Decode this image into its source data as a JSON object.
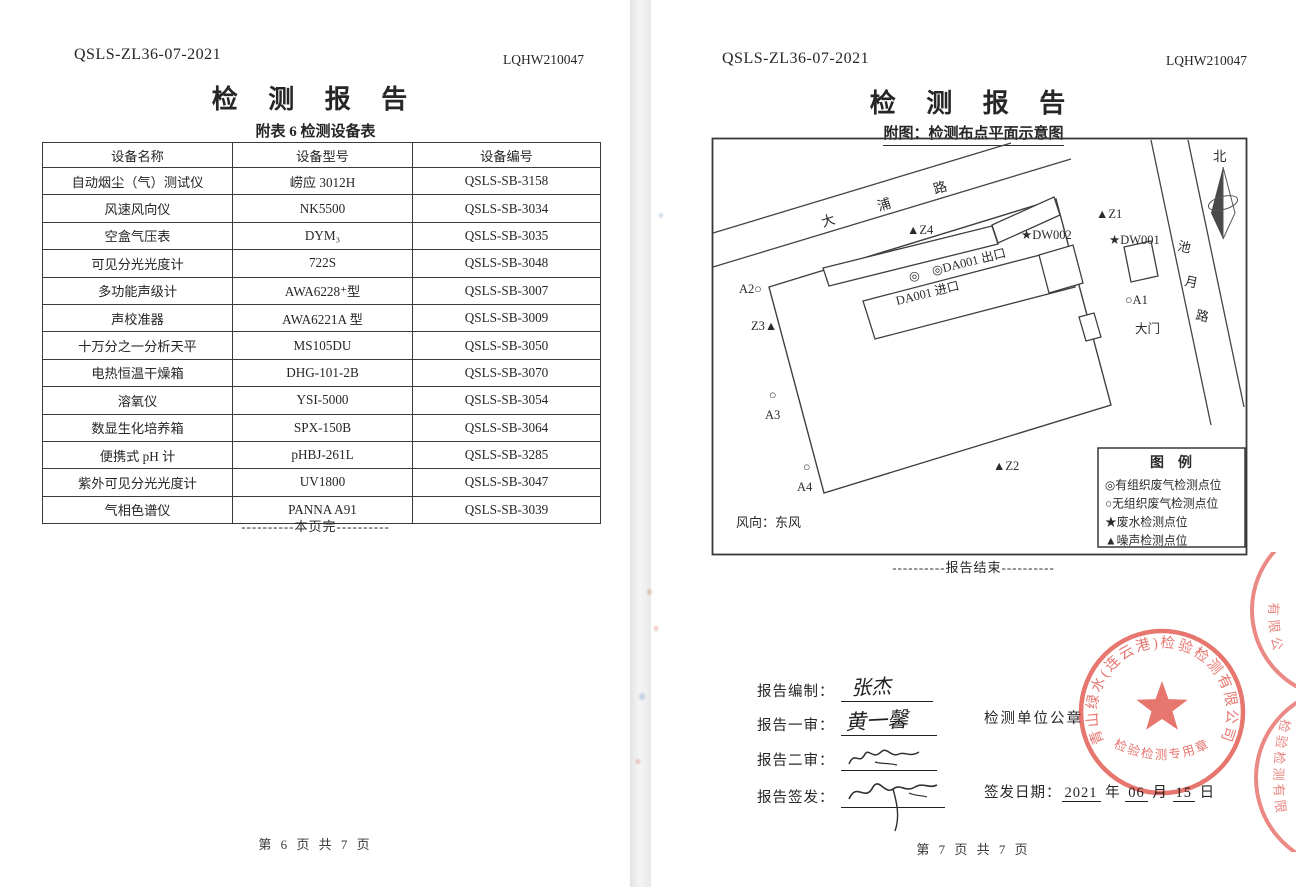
{
  "pages": {
    "left": {
      "doc_code": "QSLS-ZL36-07-2021",
      "report_no": "LQHW210047",
      "title": "检 测 报 告",
      "subtitle": "附表 6  检测设备表",
      "equipment_table": {
        "headers": [
          "设备名称",
          "设备型号",
          "设备编号"
        ],
        "rows": [
          [
            "自动烟尘（气）测试仪",
            "崂应 3012H",
            "QSLS-SB-3158"
          ],
          [
            "风速风向仪",
            "NK5500",
            "QSLS-SB-3034"
          ],
          [
            "空盒气压表",
            "DYM₃",
            "QSLS-SB-3035"
          ],
          [
            "可见分光光度计",
            "722S",
            "QSLS-SB-3048"
          ],
          [
            "多功能声级计",
            "AWA6228⁺型",
            "QSLS-SB-3007"
          ],
          [
            "声校准器",
            "AWA6221A 型",
            "QSLS-SB-3009"
          ],
          [
            "十万分之一分析天平",
            "MS105DU",
            "QSLS-SB-3050"
          ],
          [
            "电热恒温干燥箱",
            "DHG-101-2B",
            "QSLS-SB-3070"
          ],
          [
            "溶氧仪",
            "YSI-5000",
            "QSLS-SB-3054"
          ],
          [
            "数显生化培养箱",
            "SPX-150B",
            "QSLS-SB-3064"
          ],
          [
            "便携式 pH 计",
            "pHBJ-261L",
            "QSLS-SB-3285"
          ],
          [
            "紫外可见分光光度计",
            "UV1800",
            "QSLS-SB-3047"
          ],
          [
            "气相色谱仪",
            "PANNA A91",
            "QSLS-SB-3039"
          ]
        ]
      },
      "end_of_page": "----------本页完----------",
      "page_footer": "第 6 页 共 7 页"
    },
    "right": {
      "doc_code": "QSLS-ZL36-07-2021",
      "report_no": "LQHW210047",
      "title": "检 测 报 告",
      "subtitle": "附图：检测布点平面示意图",
      "diagram": {
        "roads": [
          {
            "name": "大浦路"
          },
          {
            "name": "池月路"
          }
        ],
        "north_label": "北",
        "wind_label": "风向：东风",
        "labels": [
          {
            "t": "北",
            "x": 502,
            "y": 24,
            "fs": 13.5
          },
          {
            "t": "大",
            "x": 112,
            "y": 90,
            "r": -17,
            "fs": 13.5
          },
          {
            "t": "浦",
            "x": 168,
            "y": 74,
            "r": -17,
            "fs": 13.5
          },
          {
            "t": "路",
            "x": 224,
            "y": 57,
            "r": -17,
            "fs": 13.5
          },
          {
            "t": "池",
            "x": 466,
            "y": 113,
            "r": 12,
            "fs": 13
          },
          {
            "t": "月",
            "x": 473,
            "y": 148,
            "r": 12,
            "fs": 13
          },
          {
            "t": "路",
            "x": 484,
            "y": 182,
            "r": 12,
            "fs": 13
          },
          {
            "t": "▲Z4",
            "x": 196,
            "y": 97
          },
          {
            "t": "▲Z1",
            "x": 385,
            "y": 81
          },
          {
            "t": "★DW002",
            "x": 310,
            "y": 102
          },
          {
            "t": "★DW001",
            "x": 398,
            "y": 107
          },
          {
            "t": "◎",
            "x": 198,
            "y": 143
          },
          {
            "t": "◎DA001 出口",
            "x": 222,
            "y": 138,
            "r": -14
          },
          {
            "t": "DA001 进口",
            "x": 186,
            "y": 168,
            "r": -14
          },
          {
            "t": "A2○",
            "x": 28,
            "y": 156
          },
          {
            "t": "Z3▲",
            "x": 40,
            "y": 193
          },
          {
            "t": "○A1",
            "x": 414,
            "y": 167
          },
          {
            "t": "大门",
            "x": 424,
            "y": 196
          },
          {
            "t": "○",
            "x": 58,
            "y": 262
          },
          {
            "t": "A3",
            "x": 54,
            "y": 282
          },
          {
            "t": "○",
            "x": 92,
            "y": 334
          },
          {
            "t": "A4",
            "x": 86,
            "y": 354
          },
          {
            "t": "▲Z2",
            "x": 282,
            "y": 333
          }
        ],
        "legend": {
          "title": "图　例",
          "items": [
            "◎有组织废气检测点位",
            "○无组织废气检测点位",
            "★废水检测点位",
            "▲噪声检测点位"
          ]
        }
      },
      "end_of_report": "----------报告结束----------",
      "signatures": [
        {
          "label": "报告编制：",
          "name": "张杰",
          "legible": true
        },
        {
          "label": "报告一审：",
          "name": "黄一馨",
          "legible": true
        },
        {
          "label": "报告二审：",
          "name": "",
          "legible": false
        },
        {
          "label": "报告签发：",
          "name": "",
          "legible": false
        }
      ],
      "seal_caption": "检测单位公章",
      "stamp": {
        "company": "青山绿水(连云港)检验检测有限公司",
        "type_text": "检验检测专用章",
        "color": "#e2574f",
        "partial_upper_fragment": "有限公",
        "partial_lower_fragment": "检验检测有限"
      },
      "issue_date": {
        "label": "签发日期：",
        "year": "2021",
        "year_unit": "年",
        "month": "06",
        "month_unit": "月",
        "day": "15",
        "day_unit": "日"
      },
      "page_footer": "第 7 页 共 7 页"
    }
  }
}
